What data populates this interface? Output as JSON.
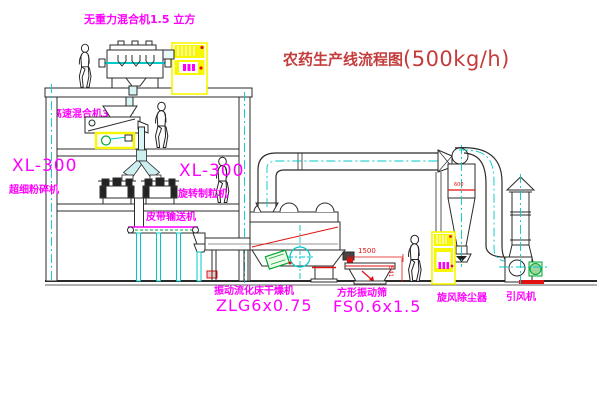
{
  "title": {
    "main": "农药生产线流程图",
    "capacity": "(500kg/h)"
  },
  "equipment_labels": {
    "gravity_free_mixer": "无重力混合机1.5 立方",
    "high_speed_mixer": "高速混合机3立方",
    "left_unit_model": "XL-300",
    "left_unit_name": "超细粉碎机",
    "granulator_model": "XL-300",
    "granulator_name": "旋转制粒机",
    "belt_conveyor": "皮带输送机",
    "fluid_bed_dryer_name": "振动流化床干燥机",
    "fluid_bed_dryer_model": "ZLG6x0.75",
    "vibrating_screen_name": "方形振动筛",
    "vibrating_screen_model": "FS0.6x1.5",
    "cyclone_collector": "旋风除尘器",
    "induced_draft_fan": "引风机"
  },
  "dimensions": {
    "screen_length": "1500",
    "screen_height": "541",
    "cyclone_width": "600"
  },
  "colors": {
    "label_magenta": "#ff00ff",
    "title_red": "#c43c3c",
    "dimension_red": "#e11111",
    "centerline_cyan": "#00c8c8",
    "highlight_yellow": "#f7f700",
    "line_dark": "#2b2b2b",
    "accent_green": "#00a832"
  }
}
